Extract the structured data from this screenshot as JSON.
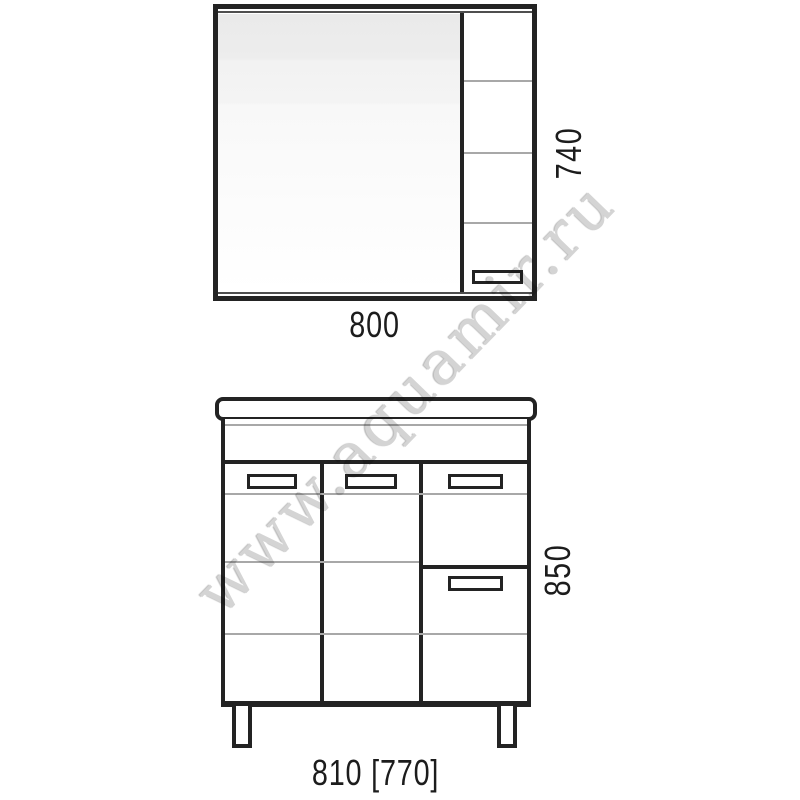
{
  "drawing": {
    "type": "furniture technical drawing",
    "colors": {
      "line": "#232323",
      "thin_line": "#a8a8a8",
      "background": "#ffffff",
      "mirror_fill_top": "#eaeaea",
      "watermark": "#d4d4d4"
    }
  },
  "watermark": {
    "text": "www.aquamir.ru"
  },
  "mirror_cabinet": {
    "width_label": "800",
    "height_label": "740"
  },
  "vanity": {
    "width_label": "810 [770]",
    "height_label": "850"
  }
}
